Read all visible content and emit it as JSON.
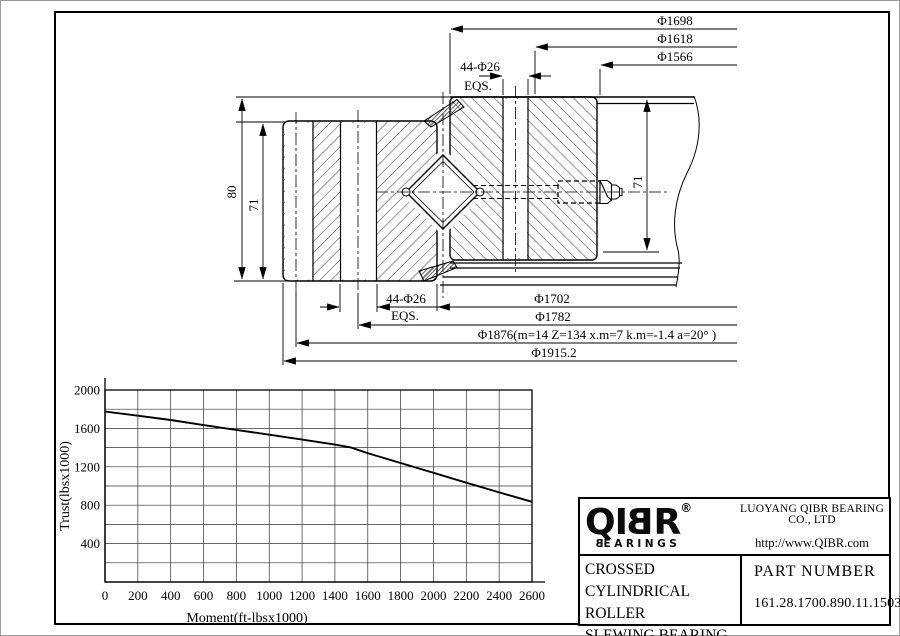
{
  "drawing": {
    "dims_top": [
      "Φ1698",
      "Φ1618",
      "Φ1566"
    ],
    "dims_bottom": [
      "Φ1702",
      "Φ1782",
      "Φ1876(m=14 Z=134 x.m=7 k.m=-1.4 a=20° )",
      "Φ1915.2"
    ],
    "bolt_top": {
      "label": "44-Φ26",
      "eqs": "EQS."
    },
    "bolt_bottom": {
      "label": "44-Φ26",
      "eqs": "EQS."
    },
    "height_outer": "80",
    "height_left": "71",
    "height_right": "71"
  },
  "chart_data": {
    "type": "line",
    "title": "",
    "xlabel": "Moment(ft-lbsx1000)",
    "ylabel": "Trust(lbsx1000)",
    "xlim": [
      0,
      2600
    ],
    "ylim": [
      0,
      2000
    ],
    "grid_step": 200,
    "grid": true,
    "legend_position": "none",
    "xticks": [
      0,
      200,
      400,
      600,
      800,
      1000,
      1200,
      1400,
      1600,
      1800,
      2000,
      2200,
      2400,
      2600
    ],
    "yticks": [
      400,
      800,
      1200,
      1600,
      2000
    ],
    "series": [
      {
        "name": "static capacity curve",
        "points": [
          [
            0,
            1775
          ],
          [
            200,
            1732
          ],
          [
            400,
            1688
          ],
          [
            600,
            1634
          ],
          [
            800,
            1584
          ],
          [
            1000,
            1534
          ],
          [
            1200,
            1483
          ],
          [
            1400,
            1431
          ],
          [
            1500,
            1400
          ],
          [
            1600,
            1342
          ],
          [
            1800,
            1240
          ],
          [
            2000,
            1137
          ],
          [
            2200,
            1034
          ],
          [
            2400,
            933
          ],
          [
            2600,
            835
          ]
        ]
      }
    ]
  },
  "title_block": {
    "logo": {
      "l1": "Q",
      "l2": "I",
      "l3": "B",
      "l4": "R",
      "reg": "®",
      "sub_first": "B",
      "sub_rest": "EARINGS"
    },
    "company": "LUOYANG QIBR BEARING CO., LTD",
    "website": "http://www.QIBR.com",
    "product_lines": [
      "CROSSED CYLINDRICAL",
      "ROLLER",
      "SLEWING BEARING"
    ],
    "part_label": "PART  NUMBER",
    "part_number": "161.28.1700.890.11.1503"
  }
}
